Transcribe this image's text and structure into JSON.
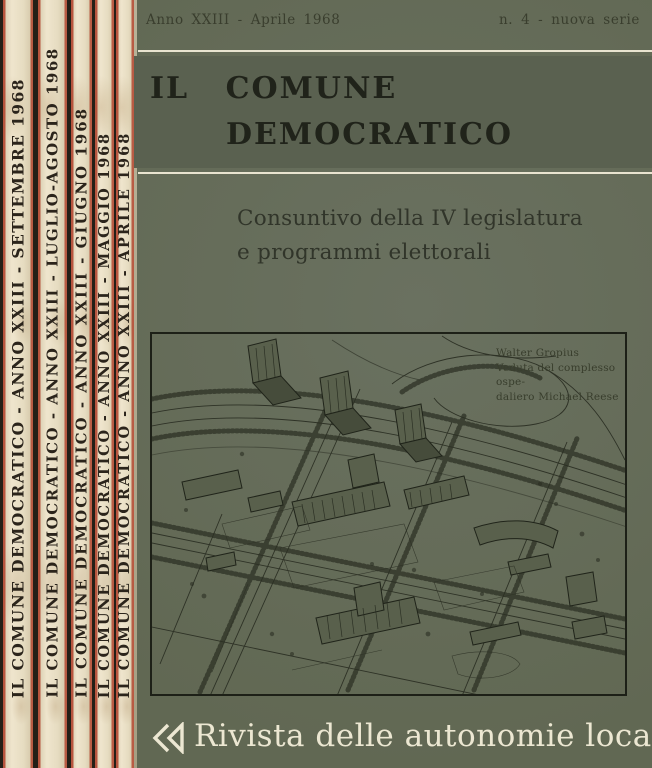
{
  "spines": [
    {
      "text": "IL COMUNE DEMOCRATICO - ANNO XXIII - SETTEMBRE 1968"
    },
    {
      "text": "IL COMUNE DEMOCRATICO - ANNO XXIII - LUGLIO-AGOSTO 1968"
    },
    {
      "text": "IL COMUNE DEMOCRATICO - ANNO XXIII - GIUGNO 1968"
    },
    {
      "text": "IL COMUNE DEMOCRATICO - ANNO XXIII - MAGGIO 1968"
    },
    {
      "text": "IL COMUNE DEMOCRATICO - ANNO XXIII - APRILE 1968"
    }
  ],
  "cover": {
    "header_left": "Anno XXIII - Aprile 1968",
    "header_right": "n. 4 - nuova serie",
    "title_line1": "IL COMUNE",
    "title_line2": "DEMOCRATICO",
    "subtitle_line1": "Consuntivo della IV legislatura",
    "subtitle_line2": "e programmi elettorali",
    "caption_lines": [
      "Walter Gropius",
      "Veduta del complesso ospe-",
      "daliero Michael Reese"
    ],
    "footer_text": "Rivista delle autonomie locali",
    "logo_icon": "double-chevron-left-mark"
  },
  "colors": {
    "cover_green": "#646b58",
    "title_band_green": "#5a6150",
    "spine_paper": "#e7ddc4",
    "spine_rule_red": "#b2402a",
    "ink_black": "#23261b",
    "cream_text": "#ece7d2"
  }
}
